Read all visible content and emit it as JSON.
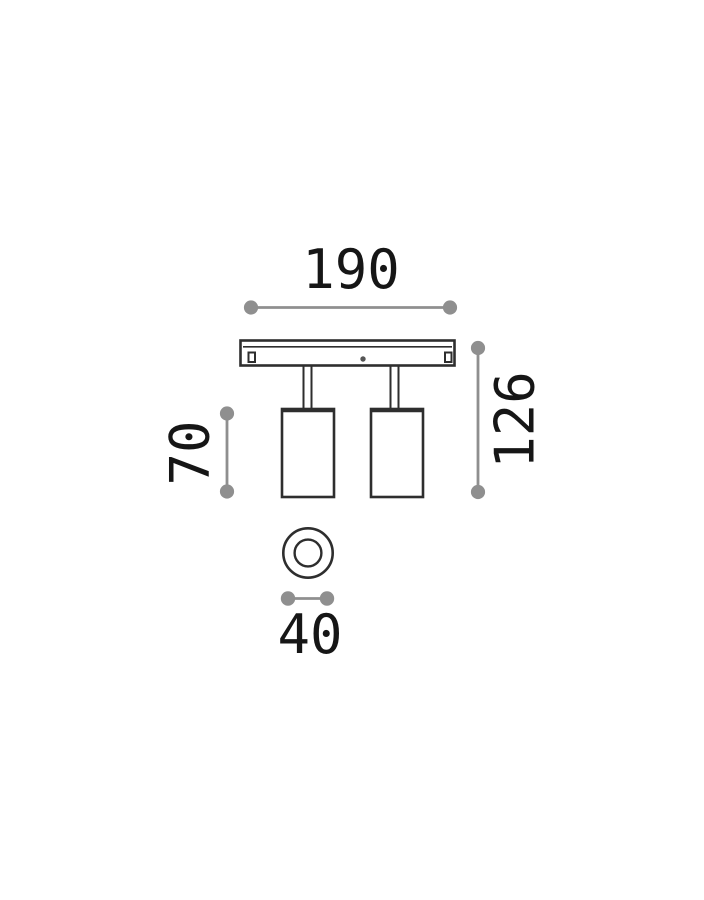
{
  "drawing": {
    "type": "product-dimension-diagram",
    "views": {
      "front": "two-spot ceiling bar with two cylindrical spotlights",
      "bottom": "circular top view of one spotlight"
    }
  },
  "dimensions": {
    "width": "190",
    "height": "126",
    "spot_length": "70",
    "spot_diameter": "40"
  },
  "colors": {
    "background": "#ffffff",
    "line": "#2e2e2e",
    "dimension": "#8f8f8f",
    "text": "#161616"
  }
}
